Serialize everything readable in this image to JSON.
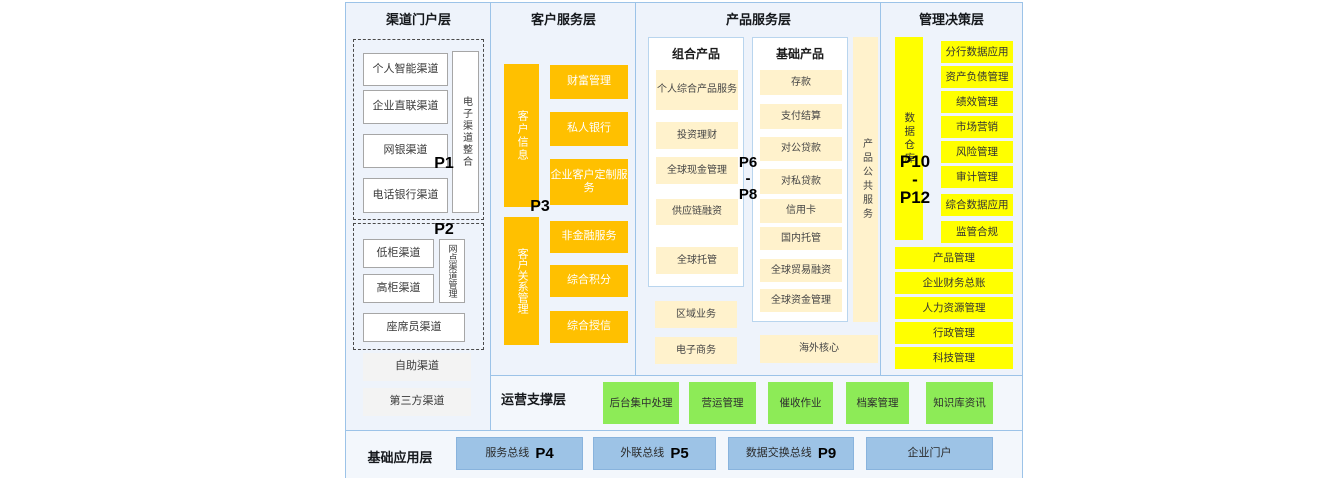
{
  "colors": {
    "column_bg": "#EEF3FB",
    "border_blue": "#9CC3E8",
    "orange": "#FFC000",
    "cream": "#FFF2CC",
    "yellow": "#FFFF00",
    "green": "#8DEB57",
    "blue": "#9DC3E6"
  },
  "channel": {
    "title": "渠道门户层",
    "p1": "P1",
    "p2": "P2",
    "e_items": [
      "个人智能渠道",
      "企业直联渠道",
      "网银渠道",
      "电话银行渠道"
    ],
    "e_side": "电子渠道整合",
    "b_items": [
      "低柜渠道",
      "高柜渠道"
    ],
    "b_side": "网点渠道管理",
    "b_wide": "座席员渠道",
    "extra": [
      "自助渠道",
      "第三方渠道"
    ]
  },
  "customer": {
    "title": "客户服务层",
    "p3": "P3",
    "bar_top": "客户信息",
    "top_items": [
      "财富管理",
      "私人银行",
      "企业客户定制服务"
    ],
    "bar_bottom": "客户关系管理",
    "bottom_items": [
      "非金融服务",
      "综合积分",
      "综合授信"
    ]
  },
  "product": {
    "title": "产品服务层",
    "p_top": "P6",
    "p_dash": "-",
    "p_bottom": "P8",
    "combo_header": "组合产品",
    "combo_items": [
      "个人综合产品服务",
      "投资理财",
      "全球现金管理",
      "供应链融资",
      "全球托管"
    ],
    "basic_header": "基础产品",
    "basic_items": [
      "存款",
      "支付结算",
      "对公贷款",
      "对私贷款",
      "信用卡",
      "国内托管",
      "全球贸易融资",
      "全球资金管理"
    ],
    "side": "产品公共服务",
    "extra": [
      "区域业务",
      "电子商务"
    ],
    "overseas": "海外核心"
  },
  "management": {
    "title": "管理决策层",
    "p_top": "P10",
    "p_dash": "-",
    "p_bottom": "P12",
    "bar": "数据仓库",
    "dw_items": [
      "分行数据应用",
      "资产负债管理",
      "绩效管理",
      "市场营销",
      "风险管理",
      "审计管理",
      "综合数据应用",
      "监管合规"
    ],
    "full_items": [
      "产品管理",
      "企业财务总账",
      "人力资源管理",
      "行政管理",
      "科技管理"
    ]
  },
  "operation": {
    "title": "运营支撑层",
    "items": [
      "后台集中处理",
      "营运管理",
      "催收作业",
      "档案管理",
      "知识库资讯"
    ]
  },
  "foundation": {
    "title": "基础应用层",
    "buses": [
      {
        "label": "服务总线",
        "p": "P4"
      },
      {
        "label": "外联总线",
        "p": "P5"
      },
      {
        "label": "数据交换总线",
        "p": "P9"
      },
      {
        "label": "企业门户",
        "p": ""
      }
    ]
  }
}
